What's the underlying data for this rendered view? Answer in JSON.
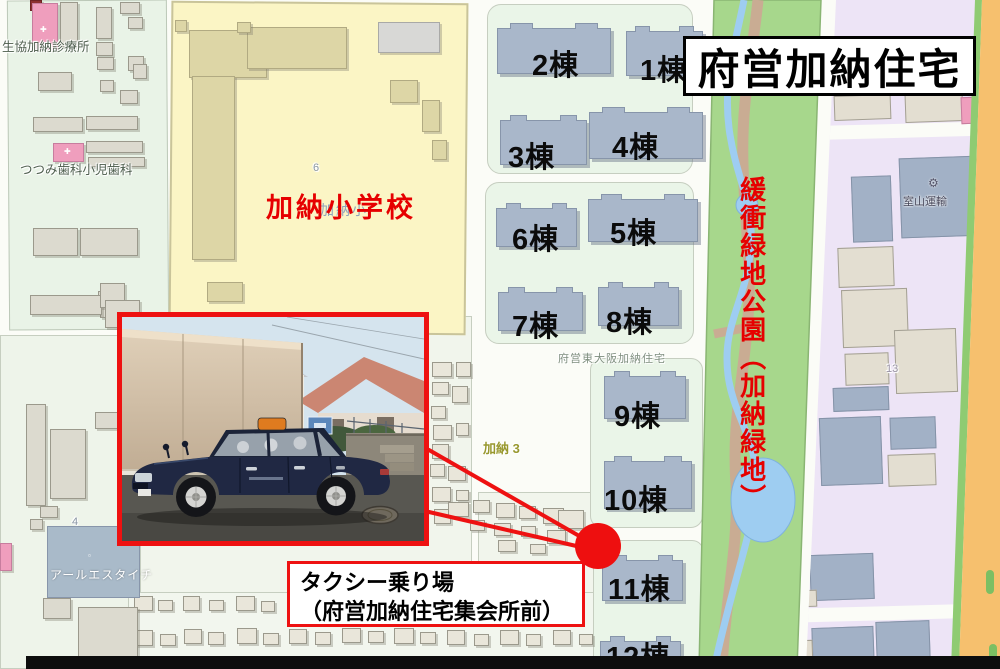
{
  "title": "府営加納住宅",
  "park_label": "緩衝緑地公園（加納緑地）",
  "school": {
    "name": "加納小学校",
    "map_name": "加納小",
    "block_no": "6"
  },
  "housing": {
    "estate_label": "府営東大阪加納住宅",
    "buildings": [
      {
        "label": "1棟"
      },
      {
        "label": "2棟"
      },
      {
        "label": "3棟"
      },
      {
        "label": "4棟"
      },
      {
        "label": "5棟"
      },
      {
        "label": "6棟"
      },
      {
        "label": "7棟"
      },
      {
        "label": "8棟"
      },
      {
        "label": "9棟"
      },
      {
        "label": "10棟"
      },
      {
        "label": "11棟"
      },
      {
        "label": "12棟"
      }
    ]
  },
  "callout": {
    "line1": "タクシー乗り場",
    "line2": "（府営加納住宅集会所前）"
  },
  "places": {
    "clinic": "生協加納診療所",
    "dental": "つつみ歯科小児歯科",
    "rs_taichi": "アールエスタイチ",
    "muroyama": "室山運輸",
    "district": "加納 3",
    "lot4": "4",
    "lot13": "13"
  },
  "icons": {
    "hospital_cross": "✚",
    "factory_gear": "⚙",
    "poi": "▫"
  },
  "colors": {
    "annotation_red": "#e60000",
    "school_yellow": "#fbf5c5",
    "park_green": "#a7d78c",
    "apartment_blue": "#a9b7ca",
    "lavender": "#ede4f6",
    "orange_road": "#f6c06e",
    "pink_poi": "#ef9ebd"
  }
}
